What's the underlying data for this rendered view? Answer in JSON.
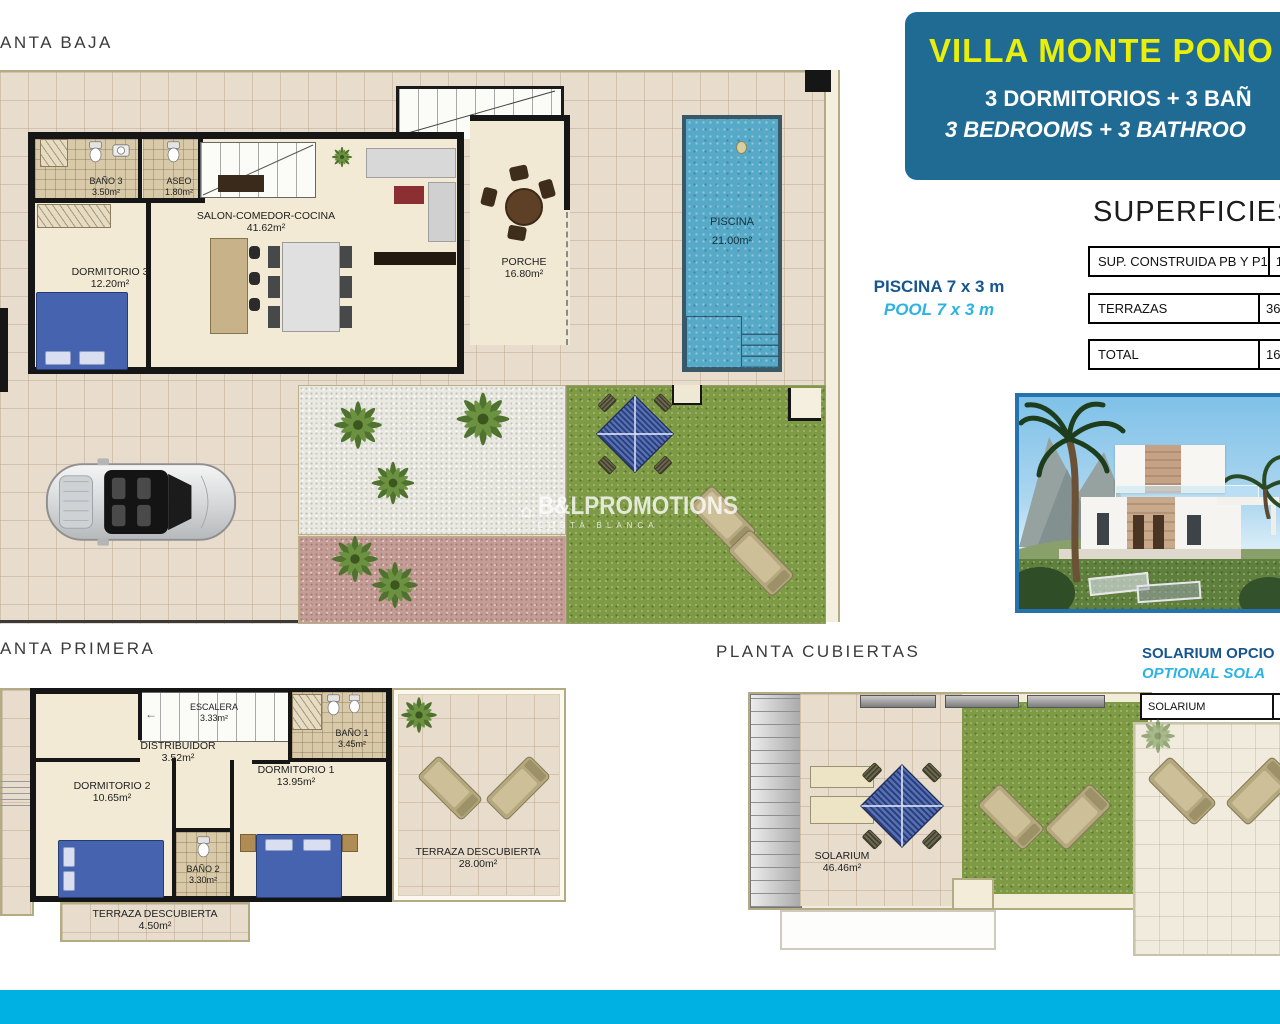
{
  "page": {
    "footer_color": "#00b1e3",
    "header_bg": "#1f6b94",
    "header_title_color": "#e9ee0a",
    "accent_dark_blue": "#17568f",
    "accent_cyan": "#2cb3e3"
  },
  "titles": {
    "planta_baja": "ANTA BAJA",
    "planta_primera": "ANTA PRIMERA",
    "planta_cubiertas": "PLANTA CUBIERTAS"
  },
  "header": {
    "title": "VILLA MONTE PONO",
    "subtitle_es": "3 DORMITORIOS + 3 BAÑ",
    "subtitle_en": "3 BEDROOMS + 3 BATHROO"
  },
  "superficies": {
    "title": "SUPERFICIES",
    "rows": [
      {
        "label": "SUP. CONSTRUIDA PB Y P1",
        "value": "129"
      },
      {
        "label": "TERRAZAS",
        "value": "36,"
      },
      {
        "label": "TOTAL",
        "value": "165"
      }
    ]
  },
  "pool_note": {
    "es": "PISCINA 7 x 3 m",
    "en": "POOL 7 x 3 m"
  },
  "solarium_note": {
    "es": "SOLARIUM OPCIO",
    "en": "OPTIONAL SOLA"
  },
  "optional_solarium": {
    "row_label": "SOLARIUM"
  },
  "rooms": {
    "pb": [
      {
        "name": "BAÑO 3",
        "area": "3.50m²"
      },
      {
        "name": "ASEO",
        "area": "1.80m²"
      },
      {
        "name": "SALON-COMEDOR-COCINA",
        "area": "41.62m²"
      },
      {
        "name": "DORMITORIO 3",
        "area": "12.20m²"
      },
      {
        "name": "PORCHE",
        "area": "16.80m²"
      },
      {
        "name": "PISCINA",
        "area": "21.00m²"
      }
    ],
    "p1": [
      {
        "name": "ESCALERA",
        "area": "3.33m²"
      },
      {
        "name": "DISTRIBUIDOR",
        "area": "3.52m²"
      },
      {
        "name": "BAÑO 1",
        "area": "3.45m²"
      },
      {
        "name": "DORMITORIO 2",
        "area": "10.65m²"
      },
      {
        "name": "DORMITORIO 1",
        "area": "13.95m²"
      },
      {
        "name": "BAÑO 2",
        "area": "3.30m²"
      },
      {
        "name": "TERRAZA DESCUBIERTA",
        "area": "28.00m²"
      },
      {
        "name": "TERRAZA DESCUBIERTA",
        "area": "4.50m²"
      }
    ],
    "pc": [
      {
        "name": "SOLARIUM",
        "area": "46.46m²"
      }
    ]
  },
  "watermark": {
    "brand": "B&LPROMOTIONS",
    "sub": "COSTA BLANCA"
  }
}
